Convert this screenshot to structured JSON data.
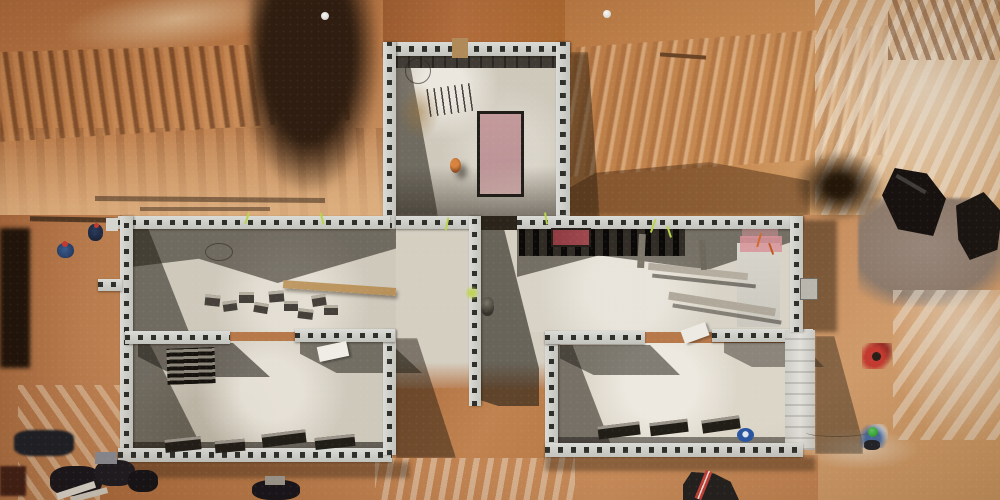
{
  "scene": {
    "description": "Aerial drone photograph of a construction site: concrete-block foundation walls of a T-shaped house laid out on pale slabs, surrounded by excavated orange-brown earth with machine striations, black plastic sheeting, material piles and several workers.",
    "setting": "construction-site-aerial",
    "weather": "sunny, hard shadows cast toward lower-right"
  },
  "colors": {
    "dirt_base": "#b8794a",
    "dirt_dark": "#8a4f2a",
    "dirt_pale": "#dcb286",
    "dirt_shadow": "#2e1d10",
    "wall_face": "#dbdbd7",
    "wall_face2": "#c3c3bd",
    "wall_dash": "#2f2f2b",
    "slab": "#cfc9bc",
    "slab_bright": "#e0dbcf",
    "shadow": "rgba(35,30,20,0.55)",
    "tarp": "#17120f",
    "mound_grey": "#8d7a6b",
    "wood": "#bf9a64",
    "form_pink": "#c49a9b",
    "form_red": "#8e3a40",
    "panel_pink": "#d89399",
    "bucket_blue": "#2a55a0",
    "helmet_green": "#3aa83a",
    "helmet_red": "#c23a30",
    "worker_blue": "#3a5a8c",
    "worker_orange": "#d8843f",
    "worker_red": "#c23a30",
    "lime_string": "#b8d44a"
  },
  "objects": {
    "rooms": [
      "top-center room with pink formwork",
      "left wing upper slab",
      "lower-left room",
      "central corridor slab",
      "middle-right room",
      "lower-right room"
    ],
    "people": [
      "worker in orange inside top room",
      "worker at central wall",
      "two workers with red helmets at left trench",
      "worker in red jacket right of building",
      "worker with green helmet and rope right of building"
    ],
    "materials": [
      "loose concrete blocks on slab",
      "wooden plank",
      "lintels inside lower rooms",
      "black plastic refuse bags",
      "black tarp sheets",
      "grey spoil mound",
      "blue bucket lid",
      "white spheres",
      "red and pink form panels"
    ]
  }
}
